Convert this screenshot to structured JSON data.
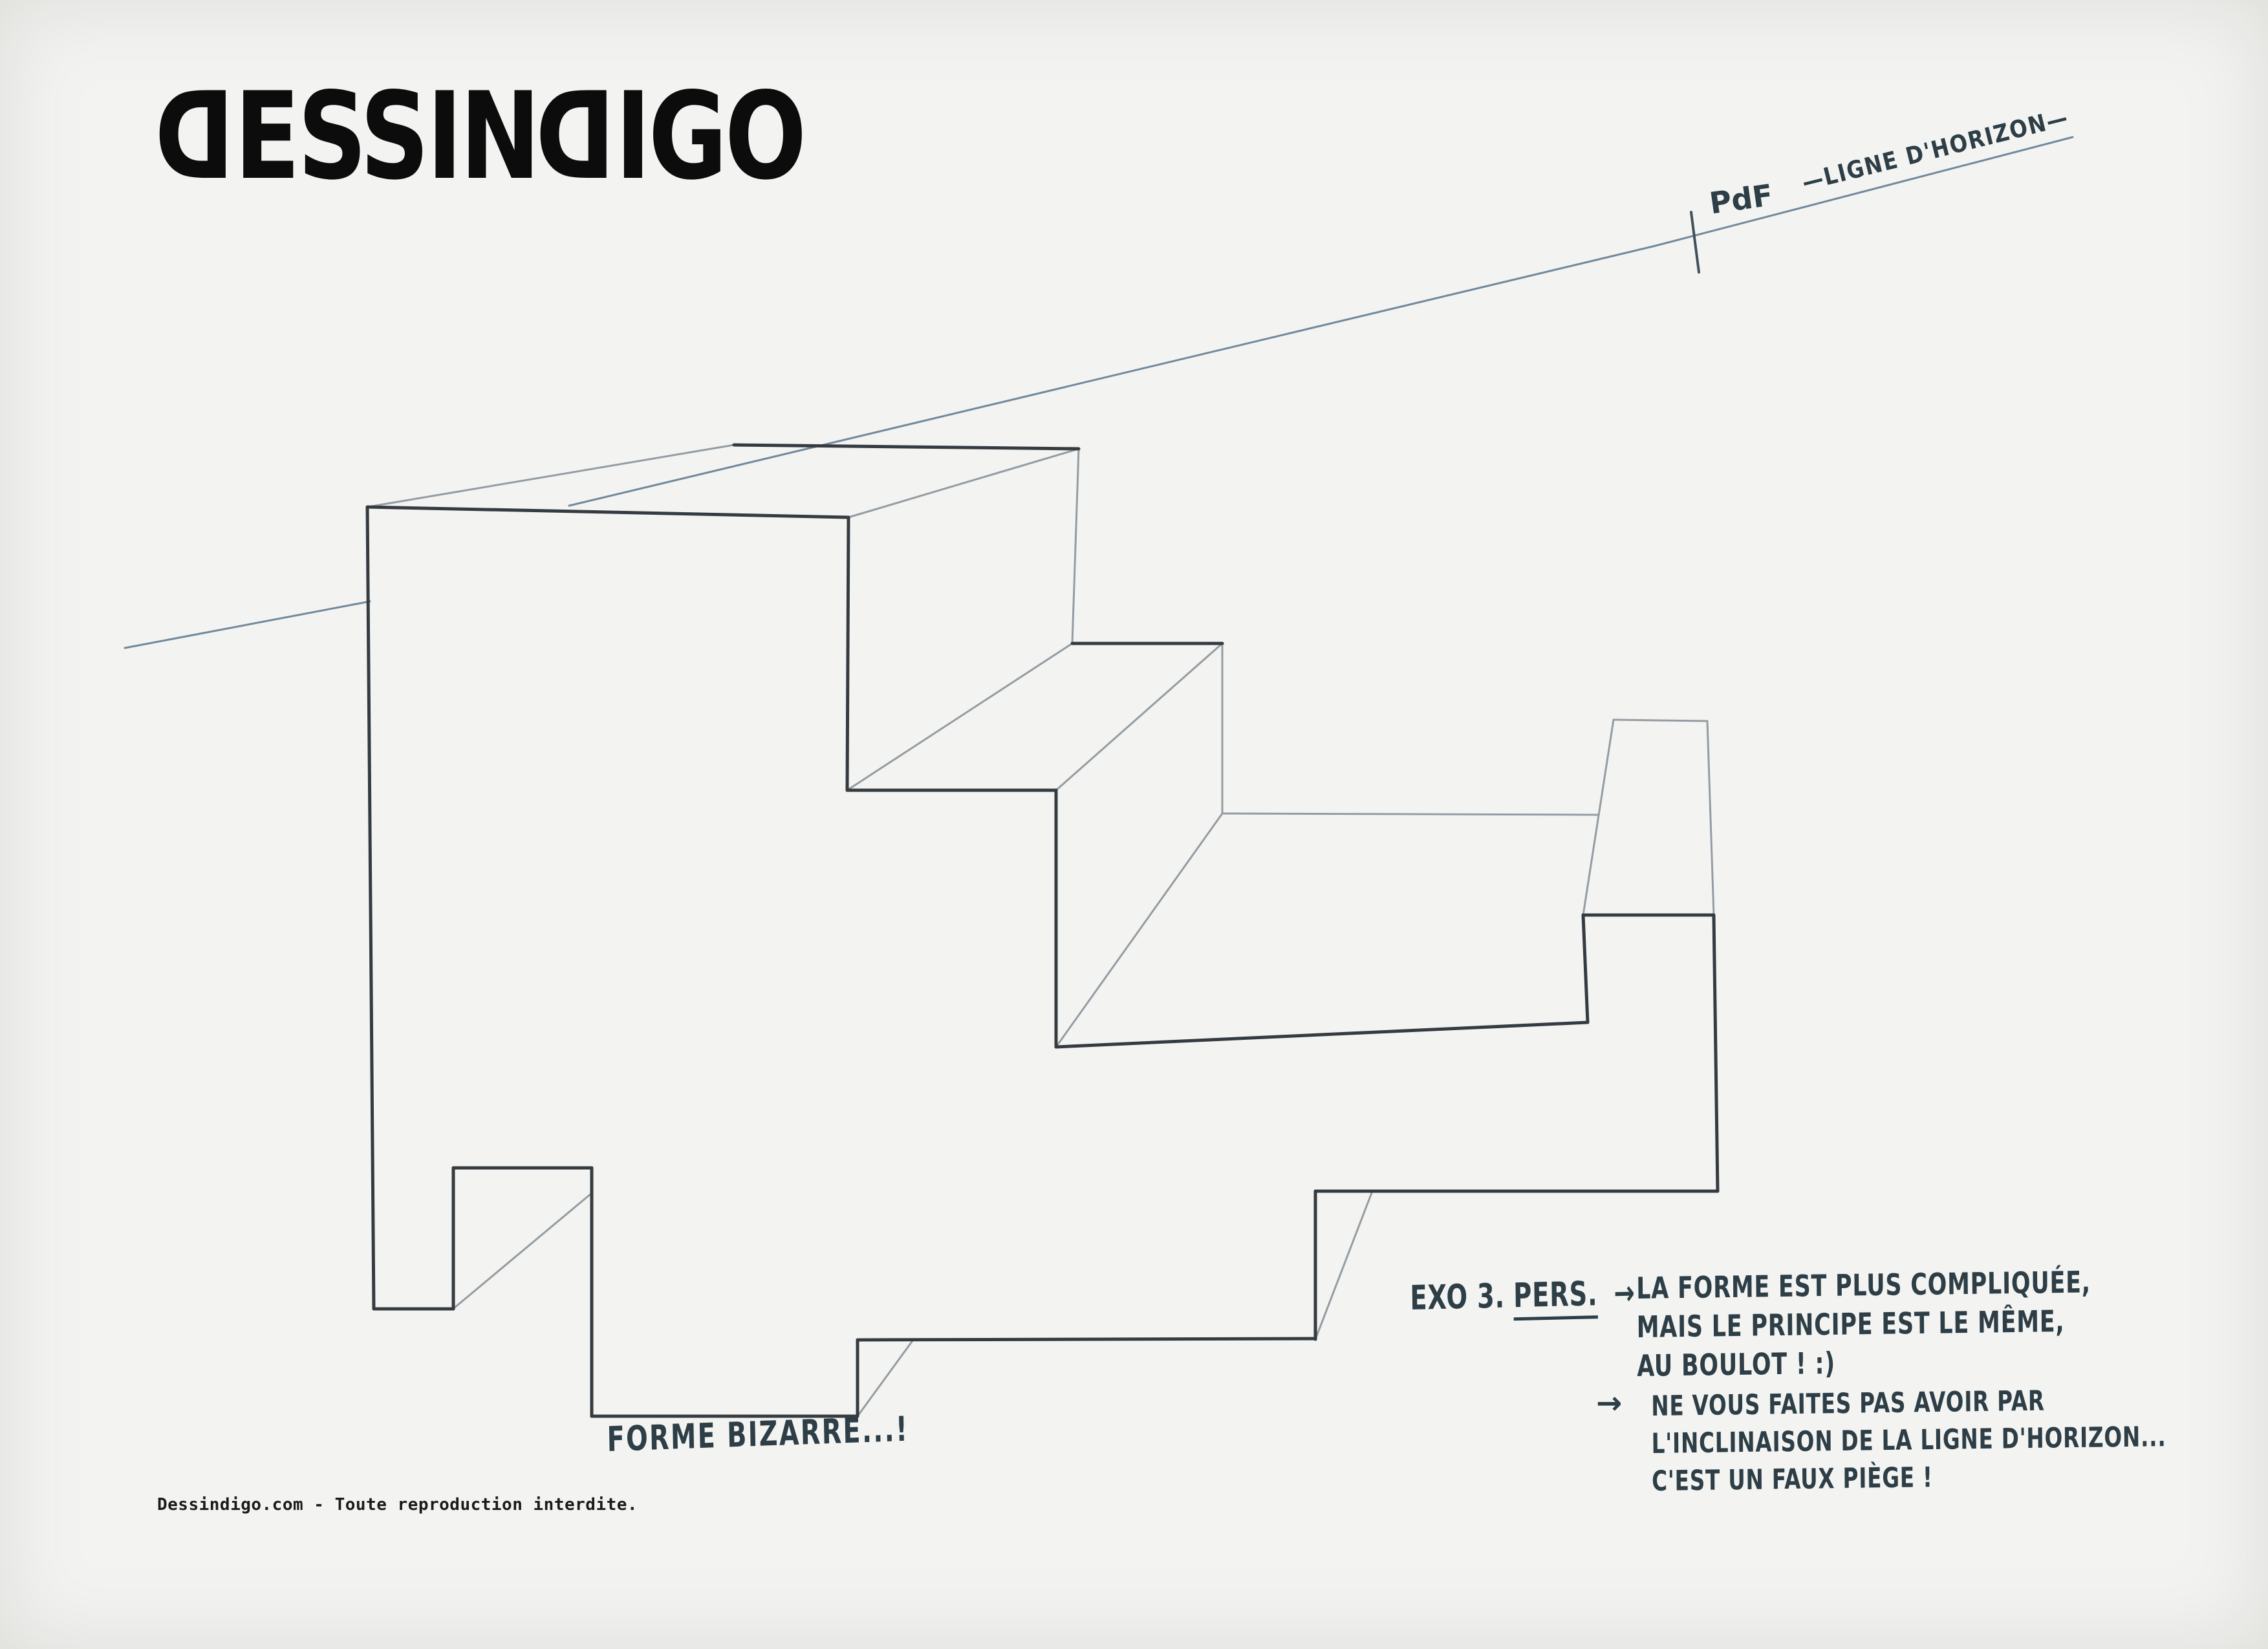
{
  "page": {
    "background": "#f3f4f1"
  },
  "logo": {
    "text": "DESSINDIGO",
    "color": "#0c0c0c",
    "mirrored_letter": "D"
  },
  "horizon": {
    "line_label": "—LIGNE D'HORIZON—",
    "point_label": "PdF",
    "color": "#72889b",
    "tick_color": "#41505c",
    "segments": [
      [
        193,
        1002,
        572,
        930
      ],
      [
        880,
        782,
        2560,
        380,
        3205,
        212
      ]
    ],
    "tick": [
      2615,
      328,
      2627,
      421
    ]
  },
  "drawing": {
    "stroke_dark": "#343b41",
    "stroke_light": "#949ca3",
    "width_dark": 5,
    "width_light": 3,
    "edges_dark": [
      [
        568,
        784,
        1312,
        800
      ],
      [
        1135,
        688,
        1668,
        694
      ],
      [
        568,
        784,
        578,
        2024
      ],
      [
        1312,
        800,
        1310,
        1222
      ],
      [
        1310,
        1222,
        1633,
        1222
      ],
      [
        1658,
        995,
        1890,
        995
      ],
      [
        1633,
        1222,
        1633,
        1619
      ],
      [
        1633,
        1619,
        2455,
        1581
      ],
      [
        578,
        2024,
        701,
        2024
      ],
      [
        701,
        2024,
        701,
        1806
      ],
      [
        701,
        1806,
        915,
        1806
      ],
      [
        915,
        1806,
        915,
        2190
      ],
      [
        915,
        2190,
        1326,
        2190
      ],
      [
        1326,
        2190,
        1326,
        2072
      ],
      [
        1326,
        2072,
        2034,
        2070
      ],
      [
        2034,
        2071,
        2034,
        1842
      ],
      [
        2034,
        1842,
        2656,
        1842
      ],
      [
        2656,
        1842,
        2650,
        1415
      ],
      [
        2448,
        1415,
        2650,
        1415
      ],
      [
        2448,
        1415,
        2455,
        1581
      ]
    ],
    "edges_light": [
      [
        568,
        784,
        1135,
        688
      ],
      [
        1312,
        800,
        1668,
        694
      ],
      [
        1668,
        694,
        1658,
        995
      ],
      [
        1310,
        1222,
        1658,
        995
      ],
      [
        1633,
        1222,
        1890,
        995
      ],
      [
        1890,
        995,
        1890,
        1258
      ],
      [
        1890,
        1258,
        2470,
        1260
      ],
      [
        1890,
        1258,
        1633,
        1619
      ],
      [
        2495,
        1113,
        2640,
        1115
      ],
      [
        2448,
        1415,
        2495,
        1113
      ],
      [
        2640,
        1115,
        2650,
        1415
      ],
      [
        703,
        2022,
        915,
        1845
      ],
      [
        1326,
        2190,
        1412,
        2072
      ],
      [
        2034,
        2071,
        2122,
        1842
      ]
    ]
  },
  "annotations": {
    "exercise_label": "EXO 3.",
    "exercise_subject": "PERS.",
    "arrow": "→",
    "note1": [
      "LA FORME EST PLUS COMPLIQUÉE,",
      "MAIS LE PRINCIPE EST LE MÊME,",
      "AU BOULOT !  :)"
    ],
    "note2": [
      "NE VOUS FAITES PAS AVOIR PAR",
      "L'INCLINAISON DE LA LIGNE D'HORIZON...",
      "C'EST UN FAUX PIÈGE !"
    ],
    "shape_caption": "FORME BIZARRE...!"
  },
  "footer": {
    "text": "Dessindigo.com - Toute reproduction interdite."
  }
}
